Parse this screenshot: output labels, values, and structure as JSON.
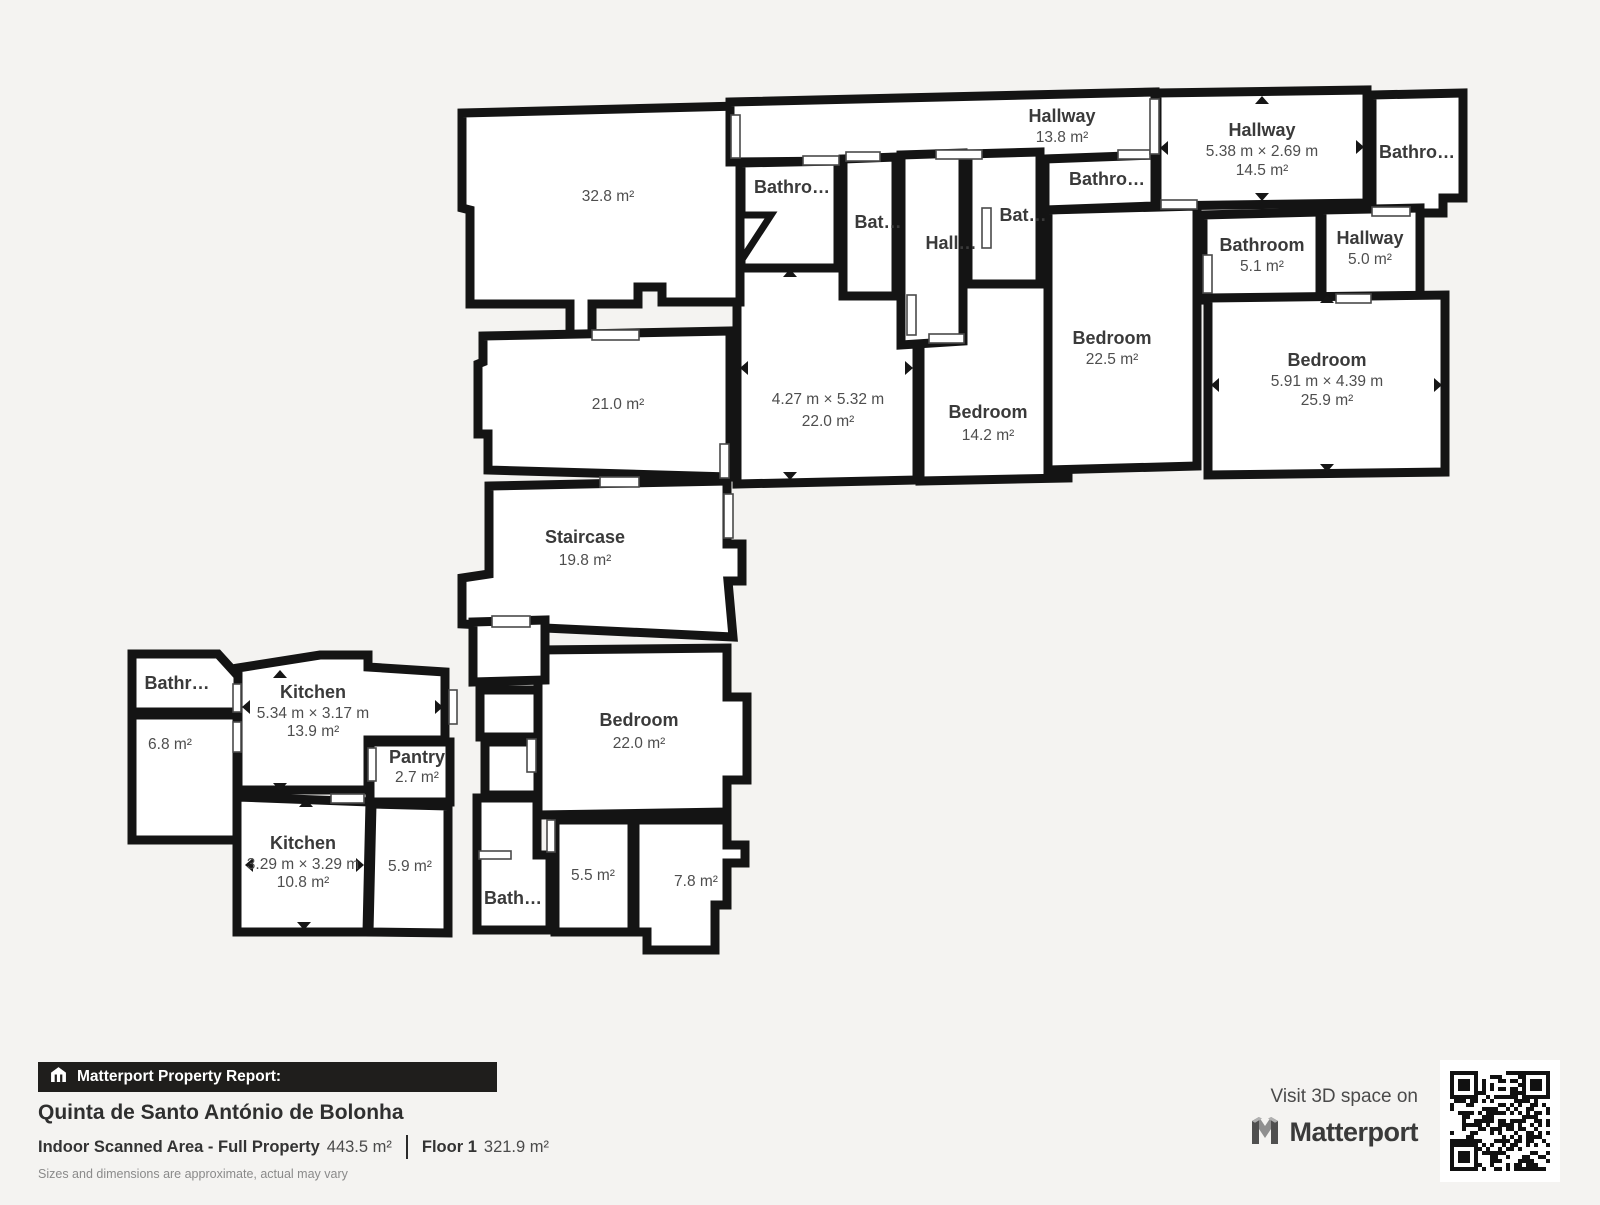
{
  "plan": {
    "rooms": {
      "living_32_8": {
        "area": "32.8 m²"
      },
      "room_21_0": {
        "area": "21.0 m²"
      },
      "staircase": {
        "name": "Staircase",
        "area": "19.8 m²"
      },
      "hallway_13_8": {
        "name": "Hallway",
        "area": "13.8 m²"
      },
      "bathroom_a": {
        "name": "Bathro…"
      },
      "bathroom_b": {
        "name": "Bat…"
      },
      "hallway_small": {
        "name": "Hall…"
      },
      "bathroom_c": {
        "name": "Bat…"
      },
      "bathroom_d": {
        "name": "Bathro…"
      },
      "bedroom_center": {
        "dims": "4.27 m × 5.32 m",
        "area": "22.0 m²"
      },
      "bedroom_14_2": {
        "name": "Bedroom",
        "area": "14.2 m²"
      },
      "bedroom_22_5": {
        "name": "Bedroom",
        "area": "22.5 m²"
      },
      "hallway_14_5": {
        "name": "Hallway",
        "dims": "5.38 m × 2.69 m",
        "area": "14.5 m²"
      },
      "bathroom_e": {
        "name": "Bathro…"
      },
      "bathroom_5_1": {
        "name": "Bathroom",
        "area": "5.1 m²"
      },
      "hallway_5_0": {
        "name": "Hallway",
        "area": "5.0 m²"
      },
      "bedroom_25_9": {
        "name": "Bedroom",
        "dims": "5.91 m × 4.39 m",
        "area": "25.9 m²"
      },
      "bathroom_f": {
        "name": "Bathr…"
      },
      "room_6_8": {
        "area": "6.8 m²"
      },
      "kitchen_13_9": {
        "name": "Kitchen",
        "dims": "5.34 m × 3.17 m",
        "area": "13.9 m²"
      },
      "pantry": {
        "name": "Pantry",
        "area": "2.7 m²"
      },
      "kitchen_10_8": {
        "name": "Kitchen",
        "dims": "3.29 m × 3.29 m",
        "area": "10.8 m²"
      },
      "room_5_9": {
        "area": "5.9 m²"
      },
      "bathroom_g": {
        "name": "Bath…"
      },
      "room_5_5": {
        "area": "5.5 m²"
      },
      "room_7_8": {
        "area": "7.8 m²"
      },
      "bedroom_bottom": {
        "name": "Bedroom",
        "area": "22.0 m²"
      }
    }
  },
  "footer": {
    "report_label": "Matterport Property Report:",
    "property_name": "Quinta de Santo António de Bolonha",
    "scanned_area_label": "Indoor Scanned Area - Full Property",
    "scanned_area_value": "443.5 m²",
    "floor_label": "Floor 1",
    "floor_value": "321.9 m²",
    "disclaimer": "Sizes and dimensions are approximate, actual may vary"
  },
  "cta": {
    "visit_label": "Visit 3D space on",
    "brand": "Matterport"
  },
  "colors": {
    "background": "#f4f3f1",
    "wall": "#141414",
    "room_fill": "#ffffff",
    "footer_bar": "#1f1e1c"
  }
}
